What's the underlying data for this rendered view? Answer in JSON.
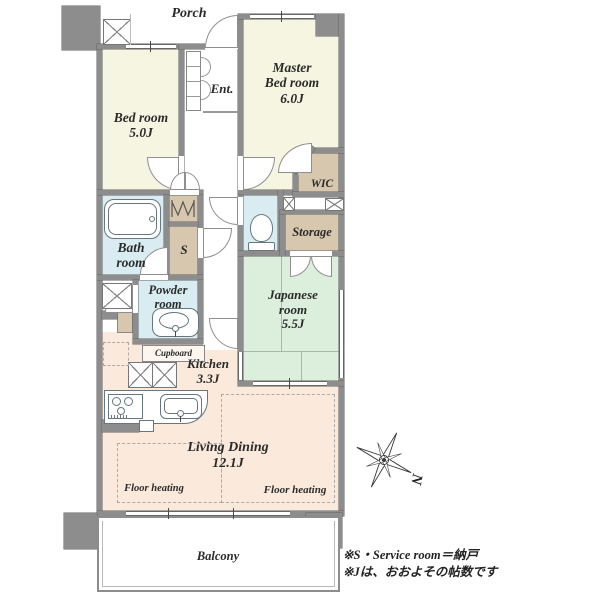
{
  "colors": {
    "wall": "#8d8d8d",
    "ivory": "#f6f5e2",
    "blue": "#d9ecf2",
    "tan": "#d7c7ae",
    "green": "#dceedc",
    "peach": "#fbe9db"
  },
  "rooms": {
    "porch": {
      "label": "Porch"
    },
    "entrance": {
      "label": "Ent."
    },
    "bedroom": {
      "name": "Bed room",
      "size": "5.0J"
    },
    "master_bedroom": {
      "line1": "Master",
      "line2": "Bed room",
      "size": "6.0J"
    },
    "wic": {
      "label": "WIC"
    },
    "storage": {
      "label": "Storage"
    },
    "bathroom": {
      "line1": "Bath",
      "line2": "room"
    },
    "service_room": {
      "label": "S"
    },
    "powder_room": {
      "line1": "Powder",
      "line2": "room"
    },
    "japanese_room": {
      "line1": "Japanese",
      "line2": "room",
      "size": "5.5J"
    },
    "cupboard": {
      "label": "Cupboard"
    },
    "kitchen": {
      "name": "Kitchen",
      "size": "3.3J"
    },
    "living_dining": {
      "name": "Living Dining",
      "size": "12.1J"
    },
    "balcony": {
      "label": "Balcony"
    }
  },
  "annotations": {
    "floor_heating_left": "Floor heating",
    "floor_heating_right": "Floor heating",
    "compass_north": "N",
    "note_line1": "※S・Service room＝納戸",
    "note_line2": "※Jは、おおよその帖数です"
  }
}
